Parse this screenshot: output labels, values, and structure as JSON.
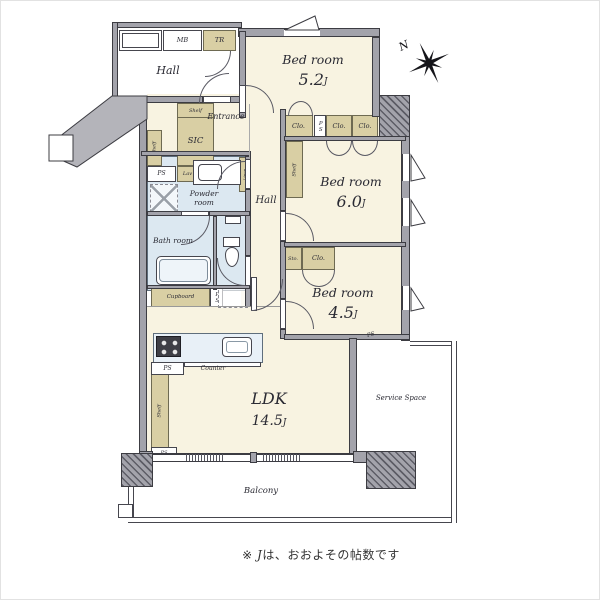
{
  "compass": {
    "north_label": "N"
  },
  "footnote": {
    "prefix": "※ ",
    "unit": "J",
    "text": "は、おおよその帖数です"
  },
  "rooms": {
    "common_hall": {
      "label": "Hall"
    },
    "entrance": {
      "label": "Entrance"
    },
    "inner_hall": {
      "label": "Hall"
    },
    "powder_room": {
      "label": "Powder room"
    },
    "bath_room": {
      "label": "Bath room"
    },
    "bedroom_52": {
      "label": "Bed room",
      "size": "5.2",
      "unit": "J"
    },
    "bedroom_60": {
      "label": "Bed room",
      "size": "6.0",
      "unit": "J"
    },
    "bedroom_45": {
      "label": "Bed room",
      "size": "4.5",
      "unit": "J"
    },
    "ldk": {
      "label": "LDK",
      "size": "14.5",
      "unit": "J"
    },
    "balcony": {
      "label": "Balcony"
    },
    "service_space": {
      "label": "Service Space"
    }
  },
  "fixtures": {
    "mb": "MB",
    "tr": "TR",
    "sic": "SIC",
    "shelf": "Shelf",
    "ps": "PS",
    "lav": "Lav",
    "linen": "Linen",
    "clo": "Clo.",
    "sto": "Sto.",
    "cupboard": "Cupboard",
    "counter": "Counter"
  },
  "colors": {
    "floor": "#f8f3e1",
    "storage": "#d9cfa4",
    "wet": "#dce8f1",
    "wall_fill": "#a3a3ab",
    "wall_line": "#3c3c42",
    "common": "#b4b4ba"
  }
}
